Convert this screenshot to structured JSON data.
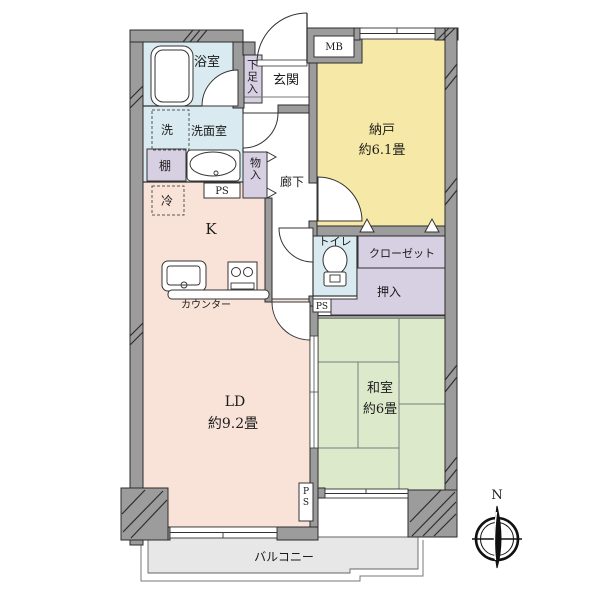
{
  "plan": {
    "rooms": {
      "bathroom": "浴室",
      "washroom": "洗面室",
      "washer": "洗",
      "shelf": "棚",
      "fridge": "冷",
      "kitchen": "K",
      "counter": "カウンター",
      "entrance": "玄関",
      "shoe_cabinet": "下足入",
      "meter_box": "MB",
      "storage_room": "納戸",
      "storage_room_size": "約6.1畳",
      "hallway": "廊下",
      "cabinet": "物入",
      "toilet": "トイレ",
      "closet": "クローゼット",
      "oshiire": "押入",
      "living_dining": "LD",
      "living_dining_size": "約9.2畳",
      "japanese_room": "和室",
      "japanese_room_size": "約6畳",
      "balcony": "バルコニー",
      "pipe_space": "PS"
    },
    "compass": {
      "north": "N"
    },
    "colors": {
      "wet_area": "#d9ebf1",
      "storage_room": "#f6e8a6",
      "living_kitchen": "#f9e3d8",
      "japanese_room": "#dde9cb",
      "closet": "#d7d0e3",
      "wall": "#9c9c9c",
      "balcony": "#e7e7e7"
    }
  }
}
